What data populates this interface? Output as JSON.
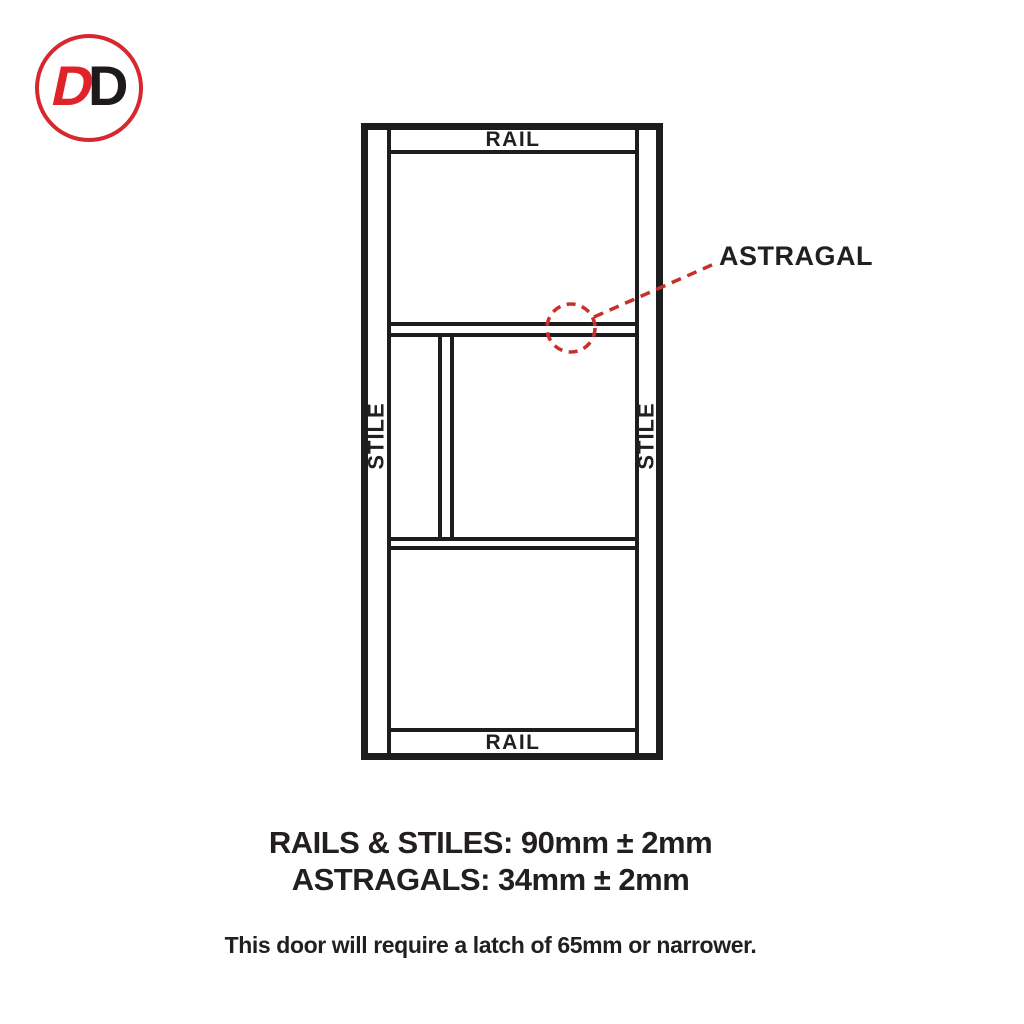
{
  "logo": {
    "d1": "D",
    "d2": "D"
  },
  "diagram": {
    "labels": {
      "rail_top": "RAIL",
      "rail_bottom": "RAIL",
      "stile_left": "STILE",
      "stile_right": "STILE",
      "astragal": "ASTRAGAL"
    }
  },
  "specs": {
    "rails_stiles": "RAILS & STILES: 90mm ± 2mm",
    "astragals": "ASTRAGALS: 34mm ± 2mm",
    "latch_note": "This door will require a latch of 65mm or narrower."
  },
  "colors": {
    "brand_red": "#d7282f",
    "annotation_red": "#c9302c",
    "ink": "#231f20",
    "line": "#1d1d1f"
  }
}
